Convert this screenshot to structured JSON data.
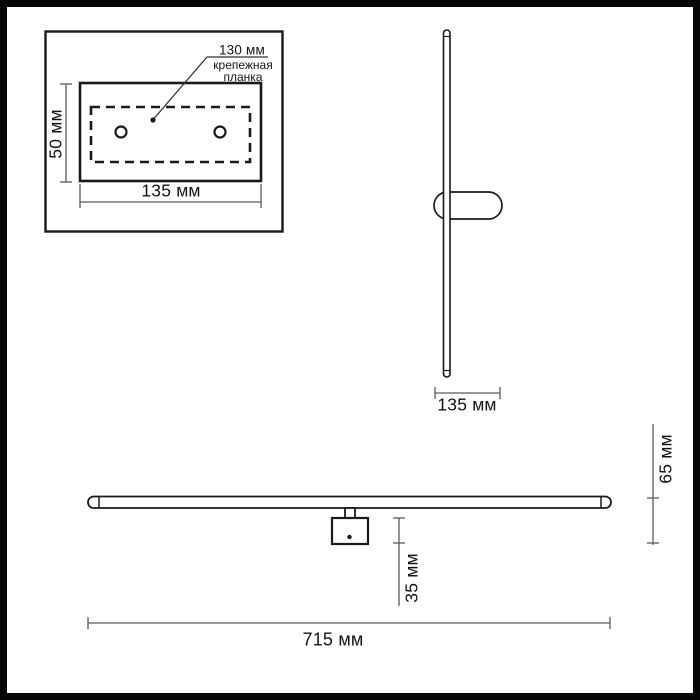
{
  "drawing": {
    "kind": "wall-light dimensional drawing",
    "units": "мм"
  },
  "labels": {
    "inset": {
      "plate_length_top": "130 мм",
      "plate_name_line1": "крепежная",
      "plate_name_line2": "планка",
      "plate_height": "50 мм",
      "plate_length_bottom": "135 мм"
    },
    "side_view": {
      "mount_depth": "135 мм"
    },
    "front_view": {
      "mount_height": "35 мм",
      "body_offset": "65 мм",
      "total_length": "715 мм"
    }
  },
  "colors": {
    "outline": "#1a1a1a",
    "dimension_line": "#5a5a5a",
    "text": "#141414",
    "background": "#ffffff",
    "frame": "#060606"
  }
}
